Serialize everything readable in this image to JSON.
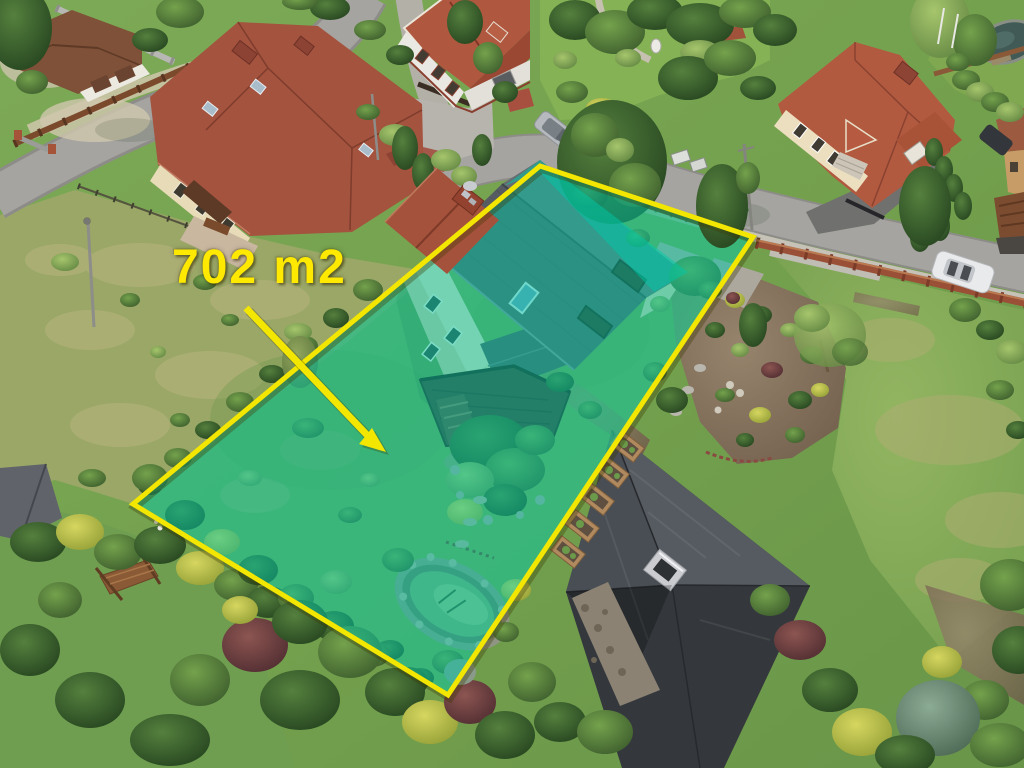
{
  "annotation": {
    "area_label": "702 m2",
    "label_color": "#ffe900",
    "border_color": "#f3e600",
    "overlay_color": "#00c8a6",
    "overlay_opacity": "0.5"
  },
  "palette": {
    "lawn": "#7ba553",
    "meadow": "#9aa767",
    "road": "#a5a4a0",
    "red_roof": "#a4533e",
    "dark_roof": "#42464b",
    "cream_wall": "#e9dfbf",
    "white_wall": "#eae8e3",
    "fence": "#8a4a30",
    "mulch": "#8a7763",
    "pond_water": "#7fa671"
  }
}
